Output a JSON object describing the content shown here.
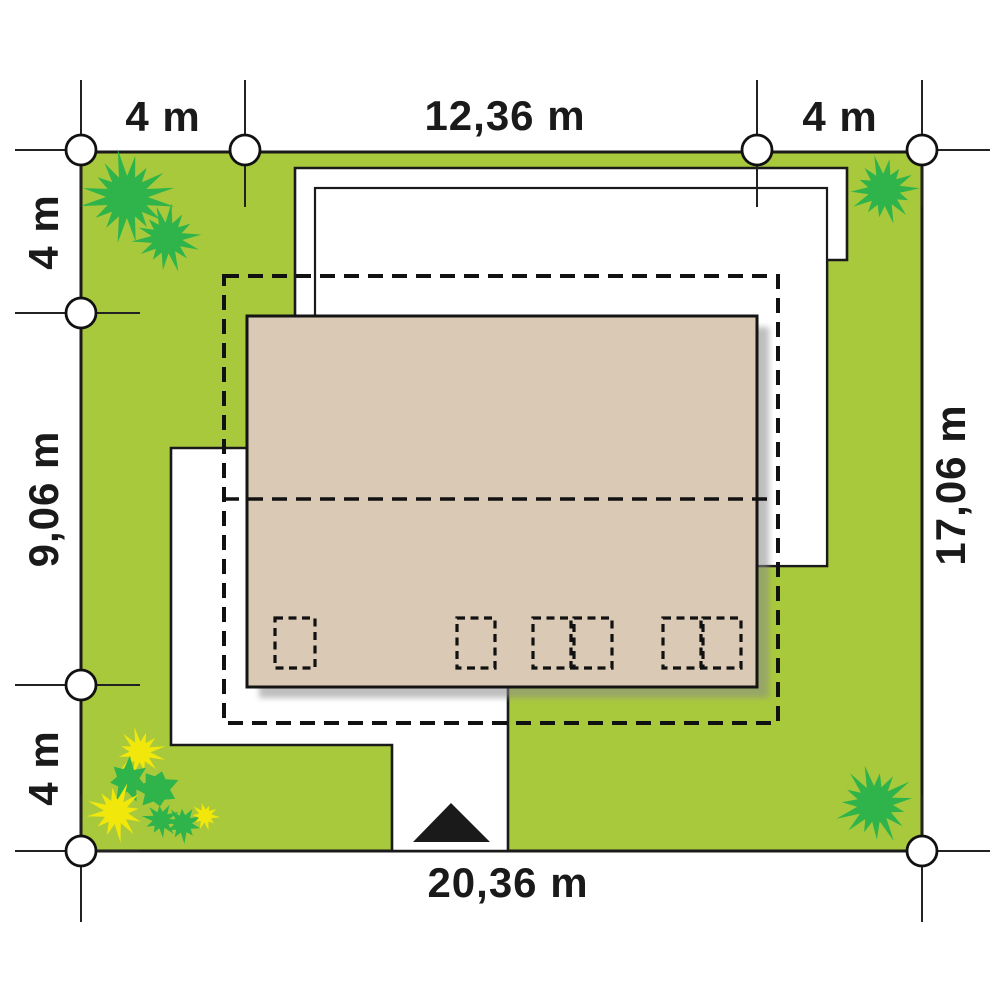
{
  "diagram": {
    "type": "house-site-plan",
    "dimensions": {
      "top": [
        "4 m",
        "12,36 m",
        "4 m"
      ],
      "left": [
        "4 m",
        "9,06 m",
        "4 m"
      ],
      "right": [
        "17,06 m"
      ],
      "bottom": [
        "20,36 m"
      ]
    }
  },
  "colors": {
    "lawn": "#A9C93C",
    "tree": "#2FB44B",
    "flower": "#F2E70B",
    "roof": "#DACAB5",
    "shadow": "#8A8A8A",
    "ink": "#1A1A1A",
    "white": "#FFFFFF"
  },
  "icons": {
    "trees": "tree-icon",
    "flowers": "flower-icon",
    "entrance": "entrance-arrow-icon",
    "survey_points": "survey-point-icon"
  }
}
